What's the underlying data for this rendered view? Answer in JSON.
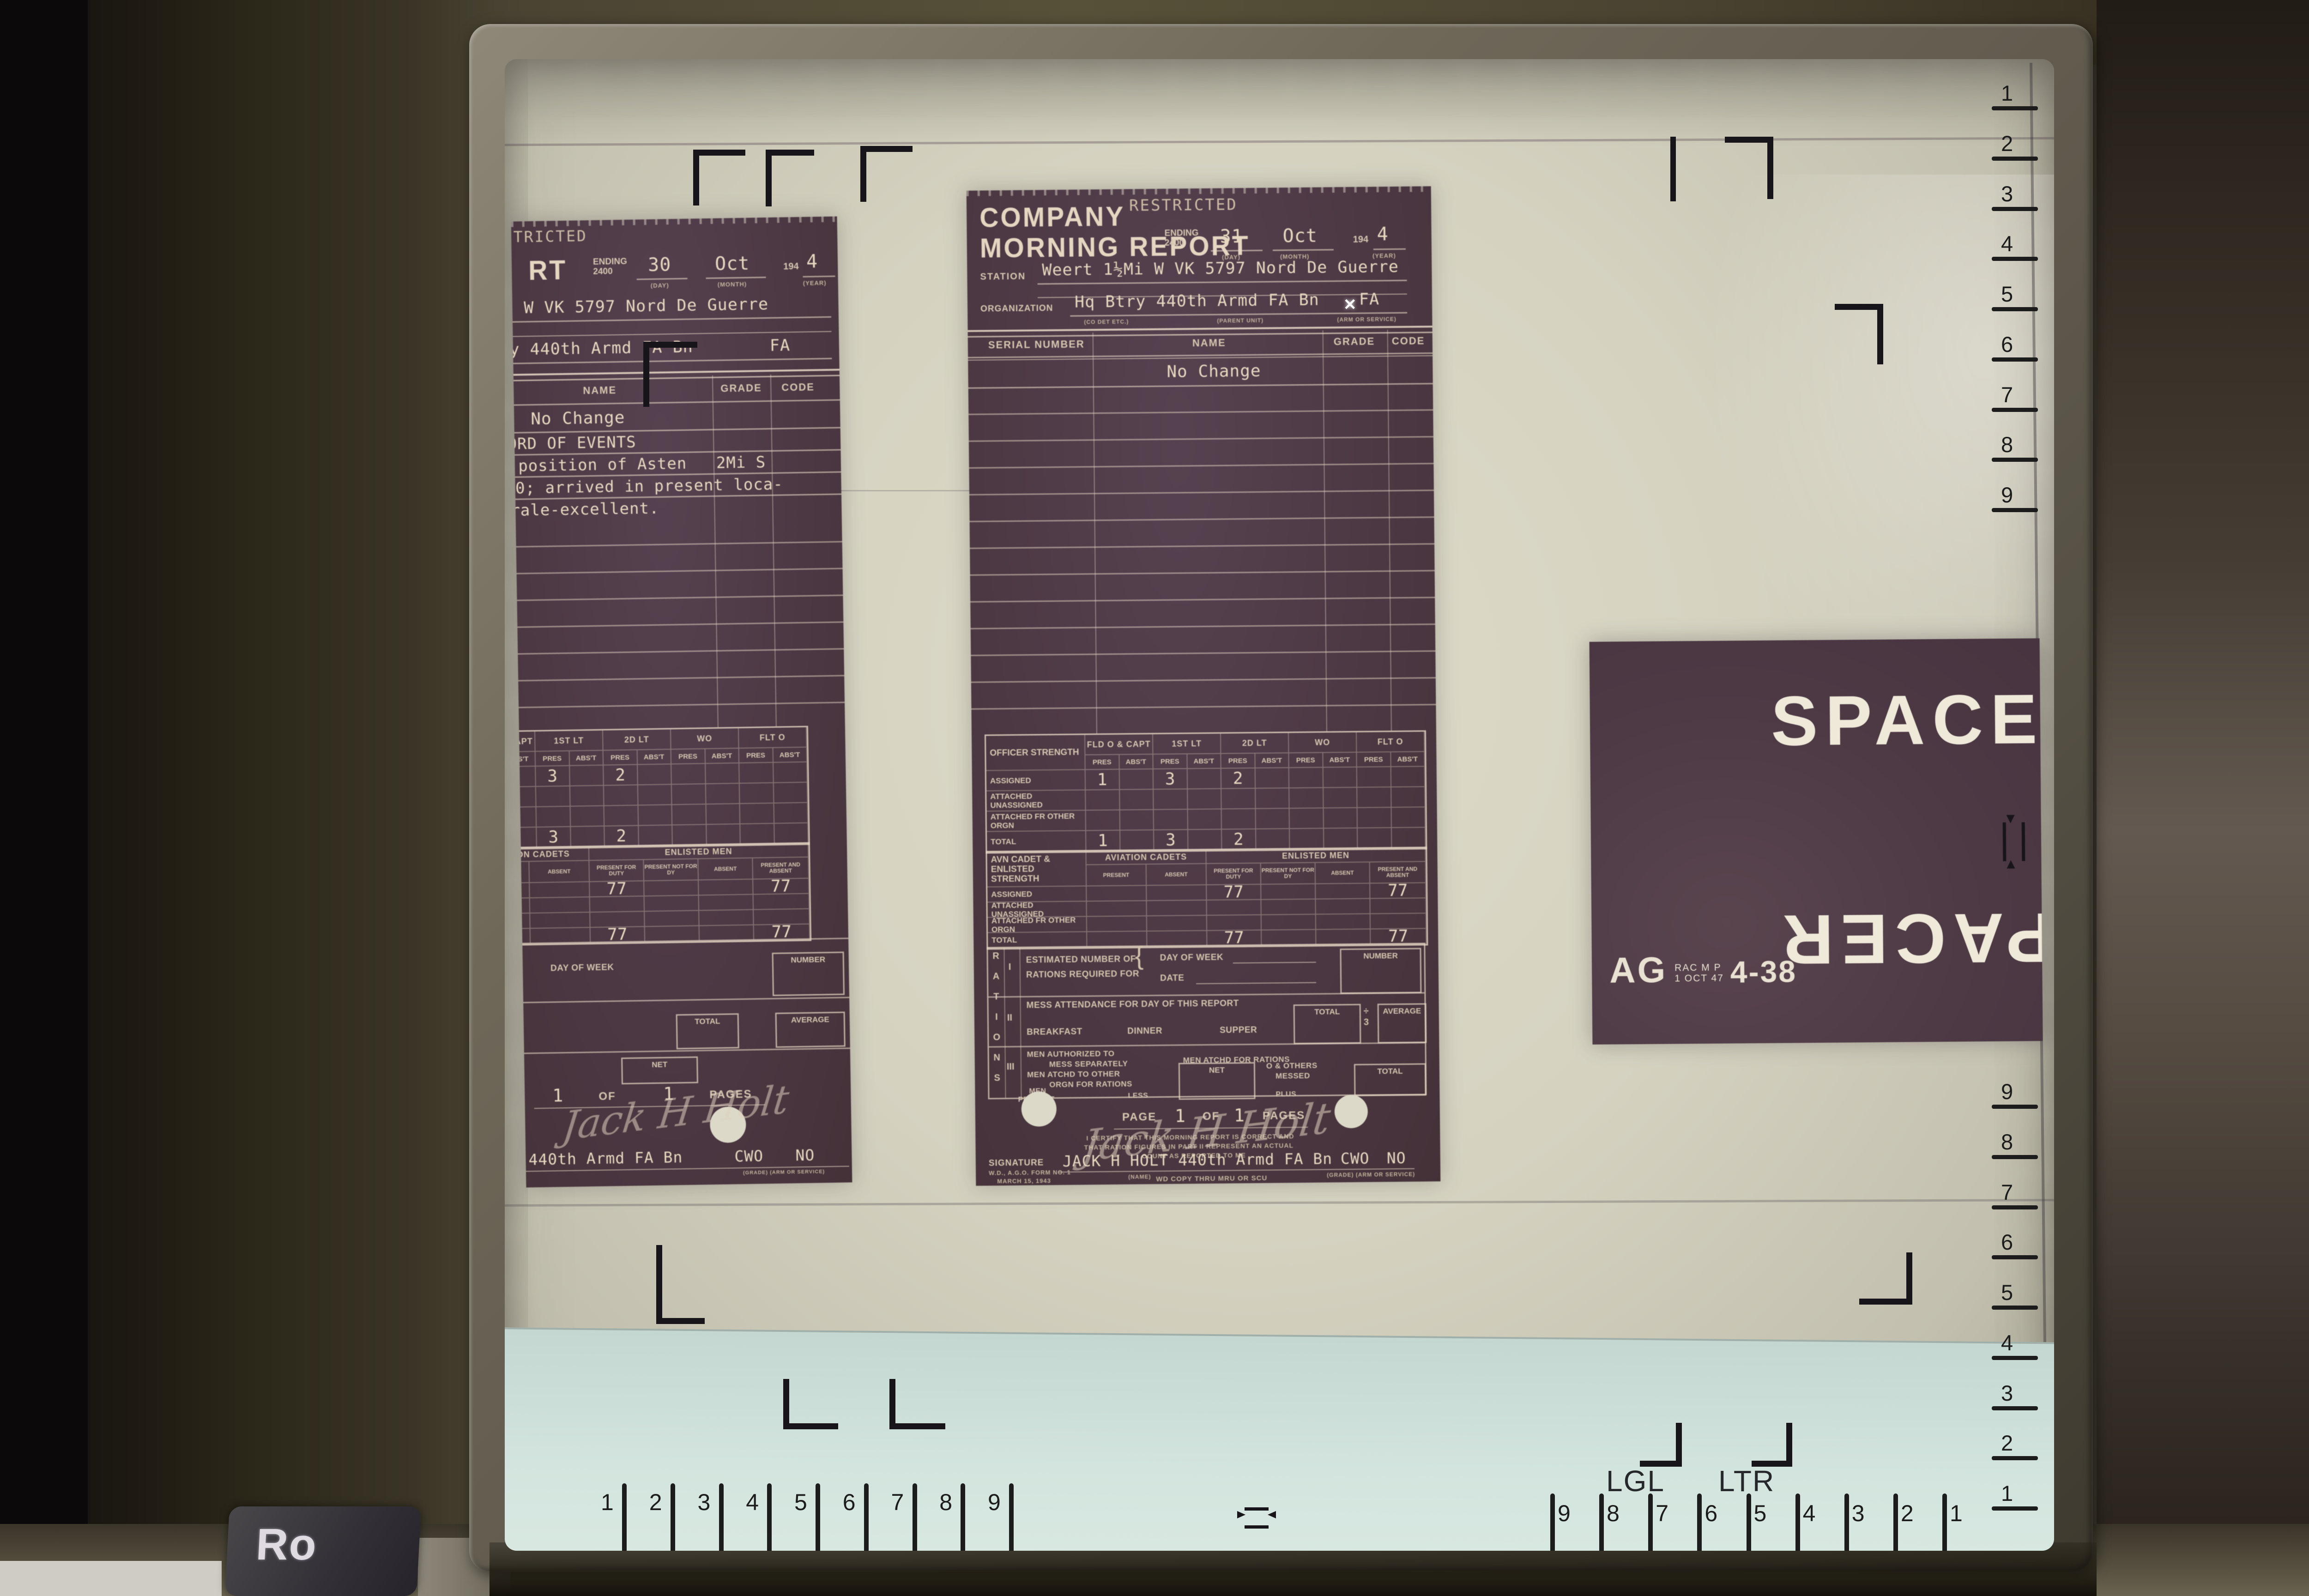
{
  "machine": {
    "brand_label": "Ro"
  },
  "screen": {
    "pointer_glyph": "✕",
    "lgl_label": "LGL",
    "ltr_label": "LTR",
    "ruler_right_top": [
      "1",
      "2",
      "3",
      "4",
      "5",
      "6",
      "7",
      "8",
      "9"
    ],
    "ruler_right_bottom": [
      "9",
      "8",
      "7",
      "6",
      "5",
      "4",
      "3",
      "2",
      "1"
    ],
    "ruler_bottom_left": [
      "1",
      "2",
      "3",
      "4",
      "5",
      "6",
      "7",
      "8",
      "9"
    ],
    "ruler_bottom_right": [
      "9",
      "8",
      "7",
      "6",
      "5",
      "4",
      "3",
      "2",
      "1"
    ]
  },
  "space_panel": {
    "top_word": "SPACE",
    "bottom_word": "PACER",
    "stamp_prefix": "AG",
    "stamp_small_line1": "RAC M P",
    "stamp_small_line2": "1 OCT 47",
    "stamp_number": "4-38"
  },
  "doc_center": {
    "classification": "RESTRICTED",
    "title_line1": "COMPANY",
    "title_line2": "MORNING REPORT",
    "ending_label1": "ENDING",
    "ending_label2": "2400",
    "day": "31",
    "month": "Oct",
    "year_prefix": "194",
    "year": "4",
    "day_caption": "(DAY)",
    "month_caption": "(MONTH)",
    "year_caption": "(YEAR)",
    "station_label": "STATION",
    "station_value": "Weert 1½Mi W VK 5797 Nord De Guerre",
    "organization_label": "ORGANIZATION",
    "organization_value": "Hq Btry 440th Armd FA Bn",
    "arm_value": "FA",
    "org_caption1": "(CO  DET  ETC.)",
    "org_caption2": "(PARENT UNIT)",
    "org_caption3": "(ARM OR SERVICE)",
    "roster_header_serial": "SERIAL NUMBER",
    "roster_header_name": "NAME",
    "roster_header_grade": "GRADE",
    "roster_header_code": "CODE",
    "roster_entry": "No Change",
    "page_label1": "PAGE",
    "page_value": "1",
    "page_label2": "OF",
    "pages_value": "1",
    "page_label3": "PAGES",
    "certify_line1": "I CERTIFY THAT THIS MORNING REPORT IS CORRECT AND",
    "certify_line2": "THAT RATION FIGURES IN PART II REPRESENT AN ACTUAL",
    "certify_line3": "COUNT AS REPORTED TO ME",
    "signature_script": "Jack H Holt",
    "signature_label": "SIGNATURE",
    "signature_value": "JACK H HOLT 440th Armd FA Bn",
    "signature_grade": "CWO",
    "signature_arm": "NO",
    "name_caption": "(NAME)",
    "grade_caption": "(GRADE)  (ARM OR SERVICE)",
    "form_line1": "W.D., A.G.O. FORM NO. 1",
    "form_line2": "MARCH 15, 1943",
    "form_footer": "WD COPY THRU MRU OR SCU"
  },
  "doc_left": {
    "classification": "RESTRICTED",
    "title_fragment": "RT",
    "ending_label1": "ENDING",
    "ending_label2": "2400",
    "day": "30",
    "month": "Oct",
    "year_prefix": "194",
    "year": "4",
    "day_caption": "(DAY)",
    "month_caption": "(MONTH)",
    "year_caption": "(YEAR)",
    "station_value": "Weert 1½Mi W VK 5797 Nord De Guerre",
    "organization_value": "Hq Btry 440th Armd FA Bn",
    "arm_value": "FA",
    "roster_header_name": "NAME",
    "roster_header_grade": "GRADE",
    "roster_header_code": "CODE",
    "roster_entry": "No Change",
    "events_title": "RECORD OF EVENTS",
    "event_line1": "Left position of Asten",
    "event_line1_right": "2Mi S",
    "event_line2": "1030; arrived in present loca-",
    "event_line3": "Morale-excellent.",
    "ration_day_label": "DAY OF WEEK",
    "ration_number_label": "NUMBER",
    "ration_total_label": "TOTAL",
    "ration_average_label": "AVERAGE",
    "ration_net_label": "NET",
    "page_value": "1",
    "page_label2": "OF",
    "pages_value": "1",
    "page_label3": "PAGES",
    "signature_script": "Jack H Holt",
    "signature_fragment": "440th Armd FA Bn",
    "signature_grade": "CWO",
    "signature_arm": "NO",
    "grade_caption": "(GRADE)  (ARM OR SERVICE)"
  },
  "strength_officer": {
    "title": "OFFICER STRENGTH",
    "groups": [
      "FLD O & CAPT",
      "1ST LT",
      "2D LT",
      "WO",
      "FLT O"
    ],
    "sub": [
      "PRES",
      "ABS'T"
    ],
    "rows": [
      {
        "label": "ASSIGNED",
        "cells": [
          "1",
          "",
          "3",
          "",
          "2",
          "",
          "",
          "",
          "",
          ""
        ]
      },
      {
        "label": "ATTACHED UNASSIGNED",
        "cells": [
          "",
          "",
          "",
          "",
          "",
          "",
          "",
          "",
          "",
          ""
        ]
      },
      {
        "label": "ATTACHED FR OTHER ORGN",
        "cells": [
          "",
          "",
          "",
          "",
          "",
          "",
          "",
          "",
          "",
          ""
        ]
      },
      {
        "label": "TOTAL",
        "cells": [
          "1",
          "",
          "3",
          "",
          "2",
          "",
          "",
          "",
          "",
          ""
        ]
      }
    ]
  },
  "strength_enlisted": {
    "title": "AVN CADET & ENLISTED STRENGTH",
    "group1": "AVIATION CADETS",
    "group2": "ENLISTED MEN",
    "sub": [
      "PRESENT",
      "ABSENT",
      "PRESENT FOR DUTY",
      "PRESENT NOT FOR DY",
      "ABSENT",
      "PRESENT AND ABSENT"
    ],
    "rows": [
      {
        "label": "ASSIGNED",
        "cells": [
          "",
          "",
          "77",
          "",
          "",
          "77"
        ]
      },
      {
        "label": "ATTACHED UNASSIGNED",
        "cells": [
          "",
          "",
          "",
          "",
          "",
          ""
        ]
      },
      {
        "label": "ATTACHED FR OTHER ORGN",
        "cells": [
          "",
          "",
          "",
          "",
          "",
          ""
        ]
      },
      {
        "label": "TOTAL",
        "cells": [
          "",
          "",
          "77",
          "",
          "",
          "77"
        ]
      }
    ]
  },
  "rations": {
    "side_letters": [
      "R",
      "A",
      "T",
      "I",
      "O",
      "N",
      "S"
    ],
    "roman1": "I",
    "roman2": "II",
    "roman3": "III",
    "i_label1": "ESTIMATED NUMBER OF",
    "i_label2": "RATIONS REQUIRED FOR",
    "i_brace": "{",
    "i_day": "DAY OF WEEK",
    "i_date": "DATE",
    "i_number": "NUMBER",
    "ii_label": "MESS ATTENDANCE FOR DAY OF THIS REPORT",
    "ii_meal1": "BREAKFAST",
    "ii_meal2": "DINNER",
    "ii_meal3": "SUPPER",
    "ii_total": "TOTAL",
    "ii_div": "÷",
    "ii_div2": "3",
    "ii_average": "AVERAGE",
    "iii_line1a": "MEN AUTHORIZED TO",
    "iii_line1b": "MESS SEPARATELY",
    "iii_line1c": "MEN ATCHD FOR RATIONS",
    "iii_line2a": "MEN ATCHD TO OTHER",
    "iii_line2b": "ORGN FOR RATIONS",
    "iii_net": "NET",
    "iii_oothers1": "O & OTHERS",
    "iii_oothers2": "MESSED",
    "iii_total": "TOTAL",
    "iii_men1": "MEN",
    "iii_men2": "PRESENT",
    "iii_less": "LESS",
    "iii_plus": "PLUS"
  }
}
